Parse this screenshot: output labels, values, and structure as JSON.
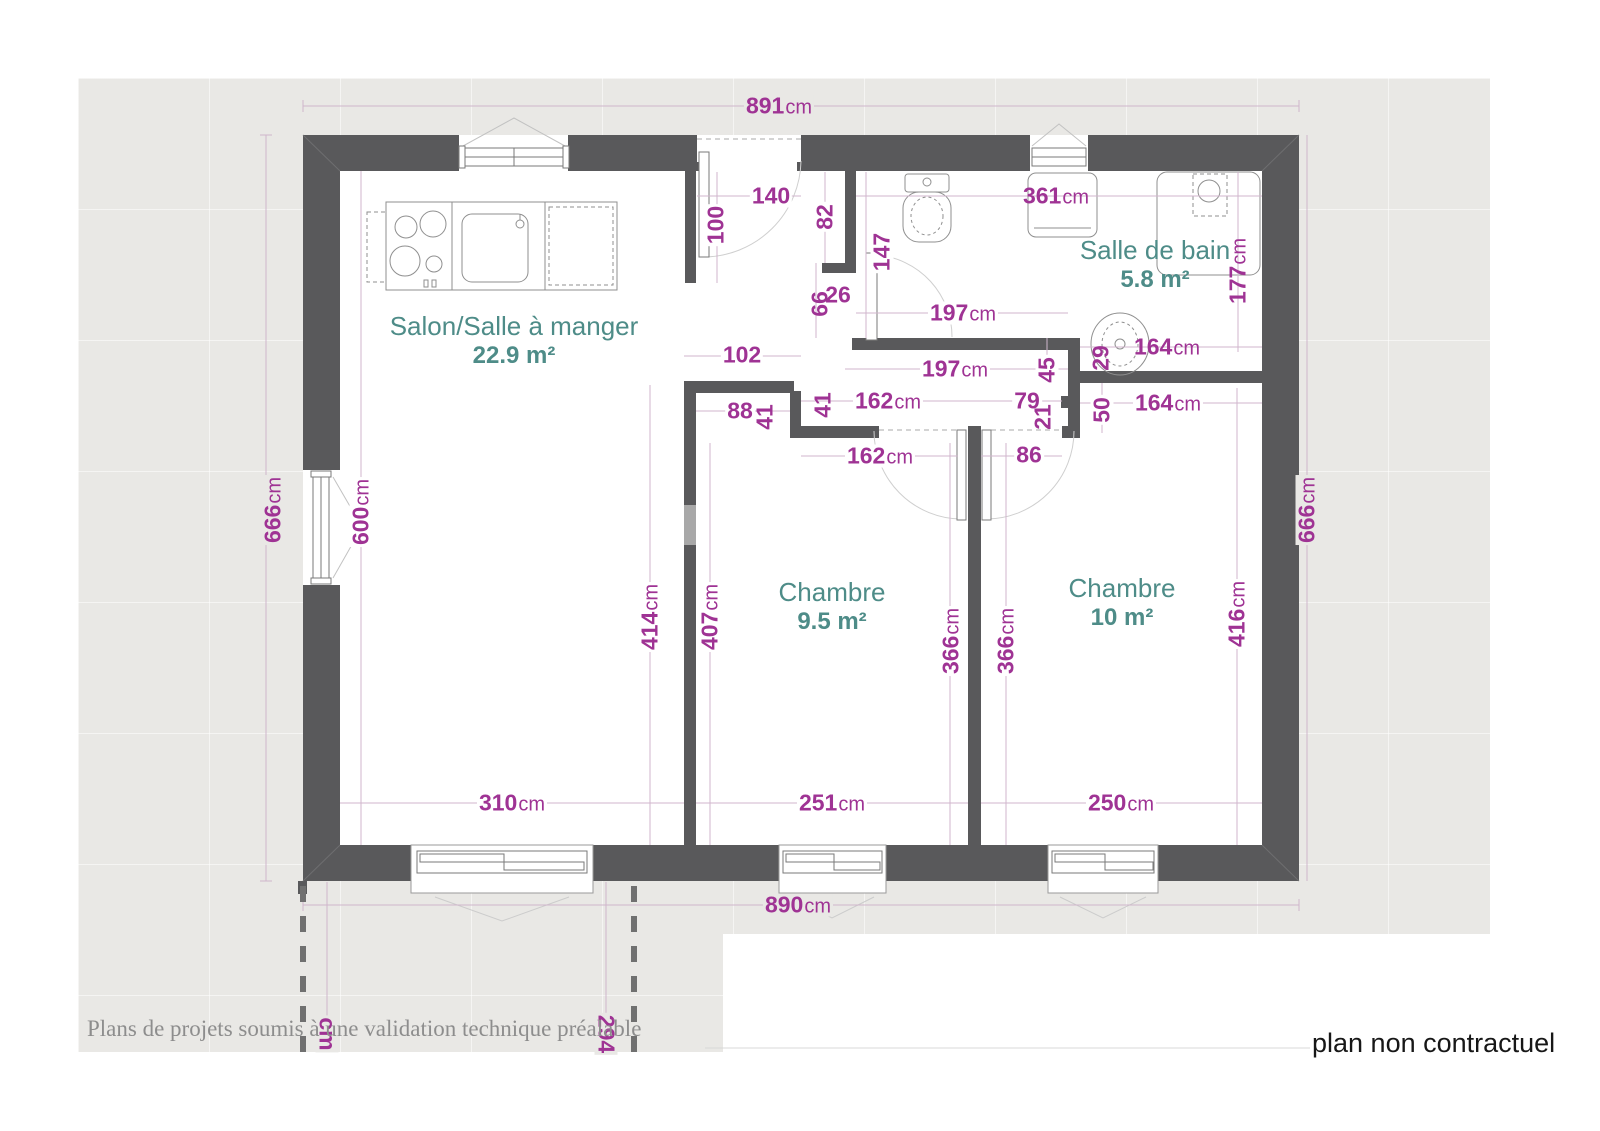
{
  "colors": {
    "wall": "#59595b",
    "dimension_text": "#9f3394",
    "room_label": "#4e8c88",
    "plan_background": "#e9e8e5",
    "dimension_line": "#d0b6cc"
  },
  "rooms": [
    {
      "name": "Salon/Salle à manger",
      "area": "22.9 m²",
      "x": 514,
      "y": 335
    },
    {
      "name": "Salle de bain",
      "area": "5.8 m²",
      "x": 1155,
      "y": 259
    },
    {
      "name": "Chambre",
      "area": "9.5 m²",
      "x": 832,
      "y": 601
    },
    {
      "name": "Chambre",
      "area": "10 m²",
      "x": 1122,
      "y": 597
    }
  ],
  "dimensions": [
    {
      "v": "891",
      "u": "cm",
      "x": 779,
      "y": 106,
      "rot": 0,
      "bg": "gray"
    },
    {
      "v": "890",
      "u": "cm",
      "x": 798,
      "y": 905,
      "rot": 0,
      "bg": "gray"
    },
    {
      "v": "666",
      "u": "cm",
      "x": 273,
      "y": 510,
      "rot": -90,
      "bg": "gray"
    },
    {
      "v": "666",
      "u": "cm",
      "x": 1307,
      "y": 510,
      "rot": -90,
      "bg": "gray"
    },
    {
      "v": "600",
      "u": "cm",
      "x": 361,
      "y": 512,
      "rot": -90,
      "bg": "white"
    },
    {
      "v": "140",
      "u": "",
      "x": 771,
      "y": 196,
      "rot": 0,
      "bg": "white"
    },
    {
      "v": "100",
      "u": "",
      "x": 716,
      "y": 225,
      "rot": -90,
      "bg": "white"
    },
    {
      "v": "82",
      "u": "",
      "x": 825,
      "y": 217,
      "rot": -90,
      "bg": "white"
    },
    {
      "v": "147",
      "u": "",
      "x": 882,
      "y": 252,
      "rot": -90,
      "bg": "white"
    },
    {
      "v": "66",
      "u": "",
      "x": 820,
      "y": 304,
      "rot": -90,
      "bg": "none"
    },
    {
      "v": "26",
      "u": "",
      "x": 838,
      "y": 295,
      "rot": 0,
      "bg": "none"
    },
    {
      "v": "361",
      "u": "cm",
      "x": 1056,
      "y": 196,
      "rot": 0,
      "bg": "none"
    },
    {
      "v": "177",
      "u": "cm",
      "x": 1238,
      "y": 271,
      "rot": -90,
      "bg": "none"
    },
    {
      "v": "197",
      "u": "cm",
      "x": 963,
      "y": 313,
      "rot": 0,
      "bg": "white"
    },
    {
      "v": "164",
      "u": "cm",
      "x": 1167,
      "y": 347,
      "rot": 0,
      "bg": "none"
    },
    {
      "v": "29",
      "u": "",
      "x": 1101,
      "y": 358,
      "rot": -90,
      "bg": "none"
    },
    {
      "v": "197",
      "u": "cm",
      "x": 955,
      "y": 369,
      "rot": 0,
      "bg": "white"
    },
    {
      "v": "45",
      "u": "",
      "x": 1047,
      "y": 370,
      "rot": -90,
      "bg": "white"
    },
    {
      "v": "102",
      "u": "",
      "x": 742,
      "y": 355,
      "rot": 0,
      "bg": "white"
    },
    {
      "v": "162",
      "u": "cm",
      "x": 888,
      "y": 401,
      "rot": 0,
      "bg": "white"
    },
    {
      "v": "79",
      "u": "",
      "x": 1027,
      "y": 401,
      "rot": 0,
      "bg": "white"
    },
    {
      "v": "21",
      "u": "",
      "x": 1043,
      "y": 417,
      "rot": -90,
      "bg": "none"
    },
    {
      "v": "50",
      "u": "",
      "x": 1102,
      "y": 410,
      "rot": -90,
      "bg": "white"
    },
    {
      "v": "164",
      "u": "cm",
      "x": 1168,
      "y": 403,
      "rot": 0,
      "bg": "white"
    },
    {
      "v": "88",
      "u": "",
      "x": 740,
      "y": 411,
      "rot": 0,
      "bg": "white"
    },
    {
      "v": "41",
      "u": "",
      "x": 765,
      "y": 417,
      "rot": -90,
      "bg": "none"
    },
    {
      "v": "41",
      "u": "",
      "x": 823,
      "y": 405,
      "rot": -90,
      "bg": "none"
    },
    {
      "v": "162",
      "u": "cm",
      "x": 880,
      "y": 456,
      "rot": 0,
      "bg": "white"
    },
    {
      "v": "86",
      "u": "",
      "x": 1029,
      "y": 455,
      "rot": 0,
      "bg": "white"
    },
    {
      "v": "414",
      "u": "cm",
      "x": 650,
      "y": 617,
      "rot": -90,
      "bg": "white"
    },
    {
      "v": "407",
      "u": "cm",
      "x": 710,
      "y": 617,
      "rot": -90,
      "bg": "white"
    },
    {
      "v": "366",
      "u": "cm",
      "x": 951,
      "y": 641,
      "rot": -90,
      "bg": "white"
    },
    {
      "v": "366",
      "u": "cm",
      "x": 1006,
      "y": 641,
      "rot": -90,
      "bg": "white"
    },
    {
      "v": "416",
      "u": "cm",
      "x": 1237,
      "y": 614,
      "rot": -90,
      "bg": "white"
    },
    {
      "v": "310",
      "u": "cm",
      "x": 512,
      "y": 803,
      "rot": 0,
      "bg": "white"
    },
    {
      "v": "251",
      "u": "cm",
      "x": 832,
      "y": 803,
      "rot": 0,
      "bg": "white"
    },
    {
      "v": "250",
      "u": "cm",
      "x": 1121,
      "y": 803,
      "rot": 0,
      "bg": "white"
    },
    {
      "v": "294",
      "u": "",
      "x": 606,
      "y": 1034,
      "rot": 90,
      "bg": "gray"
    },
    {
      "v": "cm",
      "u": "",
      "x": 327,
      "y": 1034,
      "rot": 90,
      "bg": "gray"
    }
  ],
  "footer": {
    "left": "Plans de projets soumis à une validation technique préalable",
    "right": "plan non contractuel"
  }
}
